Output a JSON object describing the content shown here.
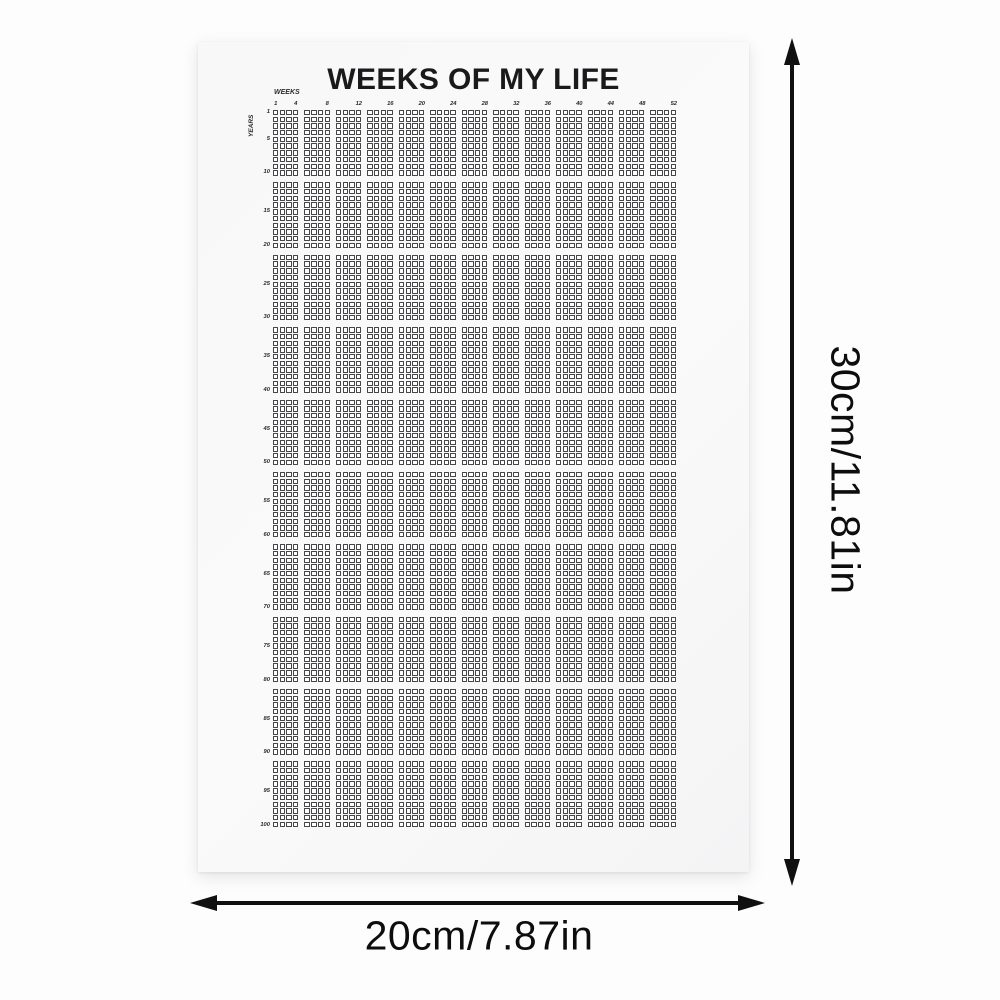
{
  "poster": {
    "title": "WEEKS OF MY LIFE",
    "weeks_axis_label": "WEEKS",
    "years_axis_label": "YEARS",
    "week_labels": [
      "1",
      "4",
      "8",
      "12",
      "16",
      "20",
      "24",
      "28",
      "32",
      "36",
      "40",
      "44",
      "48",
      "52"
    ],
    "year_labels": [
      "1",
      "5",
      "10",
      "15",
      "20",
      "25",
      "30",
      "35",
      "40",
      "45",
      "50",
      "55",
      "60",
      "65",
      "70",
      "75",
      "80",
      "85",
      "90",
      "95",
      "100"
    ],
    "grid": {
      "total_years": 100,
      "weeks_per_year": 52,
      "years_per_block": 10,
      "weeks_per_block": 4
    }
  },
  "dimensions": {
    "height_label": "30cm/11.81in",
    "width_label": "20cm/7.87in"
  },
  "colors": {
    "page_bg": "#fdfdfd",
    "poster_bg": "#f8f8f8",
    "grid_line": "#454547",
    "title_text": "#1a1a1c",
    "arrow": "#101010"
  }
}
